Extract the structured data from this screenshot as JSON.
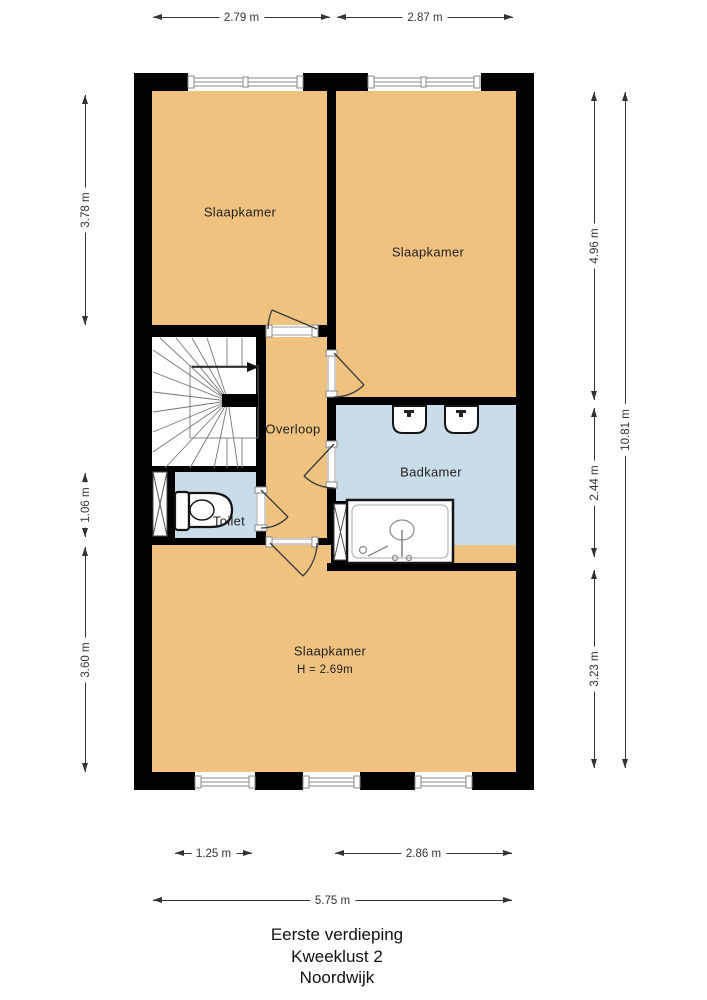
{
  "plan": {
    "title_lines": [
      "Eerste verdieping",
      "Kweeklust 2",
      "Noordwijk"
    ],
    "rooms": {
      "bedroom_top_left": {
        "label": "Slaapkamer"
      },
      "bedroom_top_right": {
        "label": "Slaapkamer"
      },
      "bedroom_bottom": {
        "label": "Slaapkamer",
        "ceiling_height": "H = 2.69m"
      },
      "landing": {
        "label": "Overloop"
      },
      "toilet": {
        "label": "Toilet"
      },
      "bathroom": {
        "label": "Badkamer"
      }
    },
    "dimensions": {
      "top": [
        "2.79 m",
        "2.87 m"
      ],
      "left": [
        "3.78 m",
        "1.06 m",
        "3.60 m"
      ],
      "right": [
        "4.96 m",
        "2.44 m",
        "3.23 m",
        "10.81 m"
      ],
      "bottom": [
        "1.25 m",
        "2.86 m",
        "5.75 m"
      ]
    },
    "colors": {
      "wall": "#000000",
      "room_floor": "#EFC280",
      "wet_room_floor": "#CBDCE9",
      "dimension_text": "#333333"
    }
  }
}
